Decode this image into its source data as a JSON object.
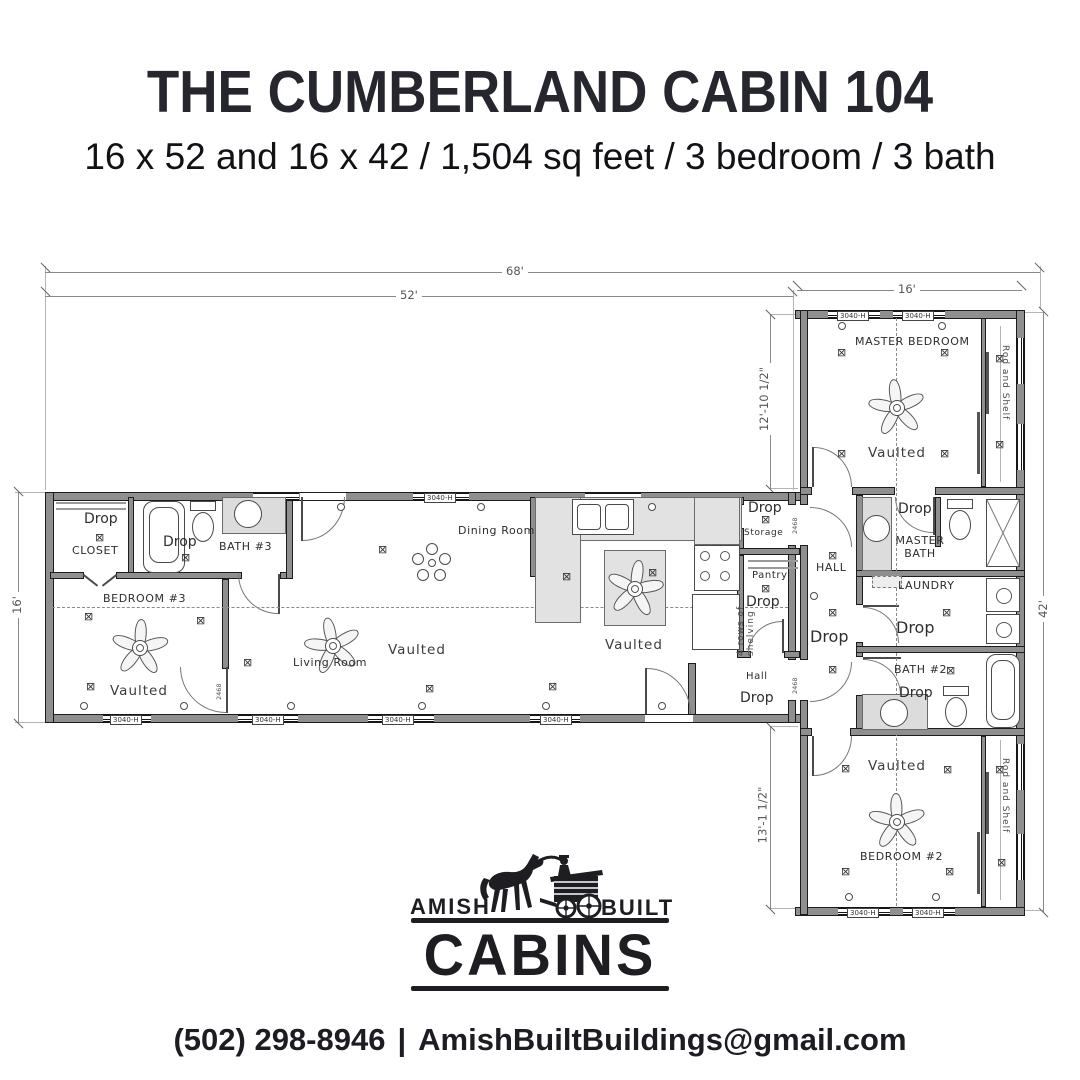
{
  "header": {
    "title": "THE CUMBERLAND CABIN 104",
    "subtitle": "16 x 52 and 16 x 42 / 1,504 sq feet / 3 bedroom / 3 bath"
  },
  "dims": {
    "overall": "68'",
    "main_width": "52'",
    "wing_width": "16'",
    "main_depth": "16'",
    "wing_upper": "12'-10 1/2\"",
    "wing_lower": "13'-1 1/2\"",
    "wing_len": "42'"
  },
  "rooms": {
    "closet": {
      "drop": "Drop",
      "name": "CLOSET"
    },
    "bath3": {
      "name": "BATH #3",
      "drop": "Drop"
    },
    "bedroom3": {
      "name": "BEDROOM #3",
      "ceiling": "Vaulted"
    },
    "living": {
      "name": "Living Room",
      "ceiling": "Vaulted"
    },
    "dining": {
      "name": "Dining Room"
    },
    "kitchen": {
      "ceiling": "Vaulted"
    },
    "storage": {
      "drop": "Drop",
      "name": "Storage"
    },
    "pantry": {
      "name": "Pantry",
      "drop": "Drop",
      "shelving": "4 rows of shelving"
    },
    "hall_main": {
      "name": "Hall",
      "drop": "Drop"
    },
    "hall_wing": {
      "name": "HALL",
      "drop": "Drop"
    },
    "master_bedroom": {
      "name": "MASTER BEDROOM",
      "ceiling": "Vaulted"
    },
    "master_bath": {
      "name": "MASTER BATH",
      "drop": "Drop"
    },
    "master_closet": {
      "name": "Rod and Shelf"
    },
    "laundry": {
      "name": "LAUNDRY",
      "drop": "Drop"
    },
    "bath2": {
      "name": "BATH #2",
      "drop": "Drop"
    },
    "bedroom2": {
      "name": "BEDROOM #2",
      "ceiling": "Vaulted"
    },
    "bedroom2_closet": {
      "name": "Rod and Shelf"
    }
  },
  "markers": {
    "window_label": "3040-H",
    "door_label": "2468"
  },
  "symbols": {
    "outlet": "⊠"
  },
  "logo": {
    "amish": "AMISH",
    "built": "BUILT",
    "cabins": "CABINS"
  },
  "contact": {
    "phone": "(502) 298-8946",
    "sep": "|",
    "email": "AmishBuiltBuildings@gmail.com"
  }
}
